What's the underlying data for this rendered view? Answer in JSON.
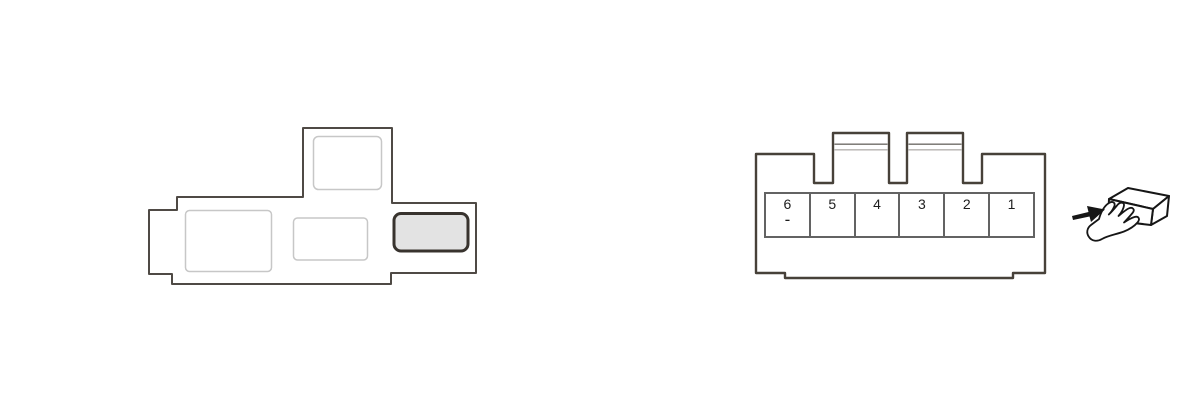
{
  "colors": {
    "canvas_bg": "#ffffff",
    "outline_dark": "#474139",
    "outline_medium": "#4f4a45",
    "slot_outline_light": "#c7c7c7",
    "highlight_border": "#38332e",
    "highlight_fill": "#e3e3e3",
    "pin_grid": "#636363",
    "pin_text": "#1d1d1d",
    "latch_line_dark": "#6f6b67",
    "latch_line_light": "#b5b2af",
    "icon_ink": "#161616"
  },
  "icons": {
    "pointer": "hand-holding-connector-icon"
  },
  "connector": {
    "pins": [
      {
        "number": "6",
        "sign": "-"
      },
      {
        "number": "5",
        "sign": ""
      },
      {
        "number": "4",
        "sign": ""
      },
      {
        "number": "3",
        "sign": ""
      },
      {
        "number": "2",
        "sign": ""
      },
      {
        "number": "1",
        "sign": ""
      }
    ]
  }
}
